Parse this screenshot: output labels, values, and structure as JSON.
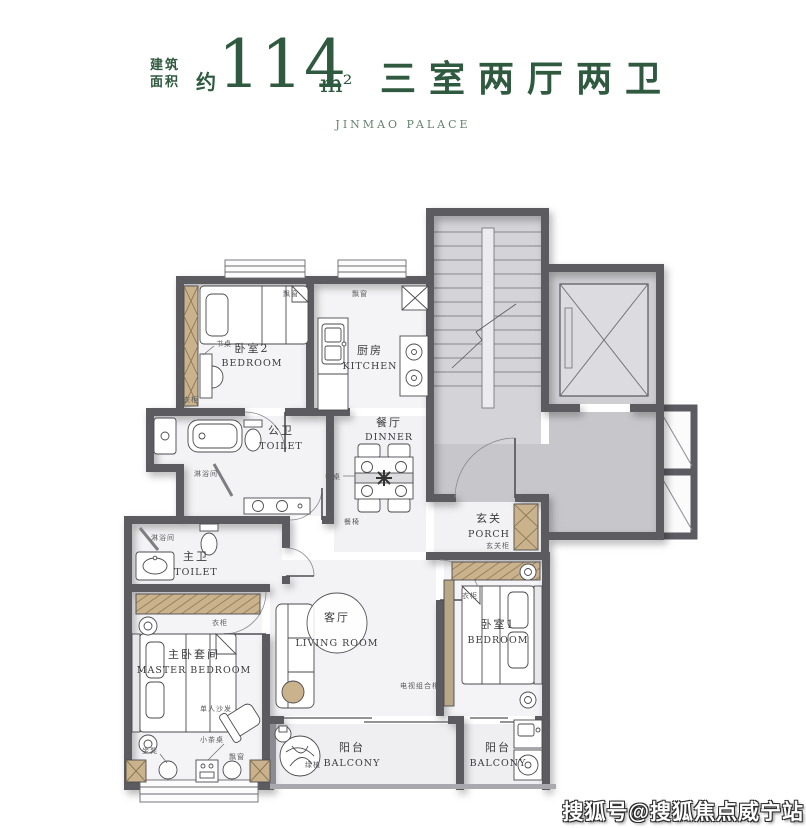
{
  "header": {
    "area_label_line1": "建筑",
    "area_label_line2": "面积",
    "approx": "约",
    "area_value": "114",
    "area_unit": "m²",
    "layout_title": "三室两厅两卫",
    "subtitle": "JINMAO PALACE",
    "accent_color": "#2f5a40"
  },
  "rooms": {
    "bedroom2": {
      "cn": "卧室2",
      "en": "BEDROOM"
    },
    "kitchen": {
      "cn": "厨房",
      "en": "KITCHEN"
    },
    "public_toilet": {
      "cn": "公卫",
      "en": "TOILET"
    },
    "dinner": {
      "cn": "餐厅",
      "en": "DINNER"
    },
    "master_toilet": {
      "cn": "主卫",
      "en": "TOILET"
    },
    "porch": {
      "cn": "玄关",
      "en": "PORCH"
    },
    "living": {
      "cn": "客厅",
      "en": "LIVING ROOM"
    },
    "master_bedroom": {
      "cn": "主卧套间",
      "en": "MASTER BEDROOM"
    },
    "bedroom1": {
      "cn": "卧室1",
      "en": "BEDROOM"
    },
    "balcony_left": {
      "cn": "阳台",
      "en": "BALCONY"
    },
    "balcony_right": {
      "cn": "阳台",
      "en": "BALCONY"
    }
  },
  "annotations": {
    "bay_window_br2": "飘窗",
    "bay_window_kitchen": "飘窗",
    "bay_window_master": "飘窗",
    "desk": "书桌",
    "wardrobe_br2": "衣柜",
    "shower_public": "淋浴间",
    "shower_master": "淋浴间",
    "dining_table": "餐桌",
    "dining_chair": "餐椅",
    "porch_cabinet": "玄关柜",
    "wardrobe_master": "衣柜",
    "wardrobe_br1": "衣柜",
    "tv_cabinet": "电视组合柜",
    "single_sofa": "单人沙发",
    "tea_table": "小茶桌",
    "stool": "坐凳",
    "plant": "绿植"
  },
  "colors": {
    "wall": "#5b5b61",
    "wood": "#c9b28c",
    "common_floor": "#c7c7cb",
    "room_floor": "#f4f4f6"
  },
  "watermark": "搜狐号@搜狐焦点威宁站"
}
